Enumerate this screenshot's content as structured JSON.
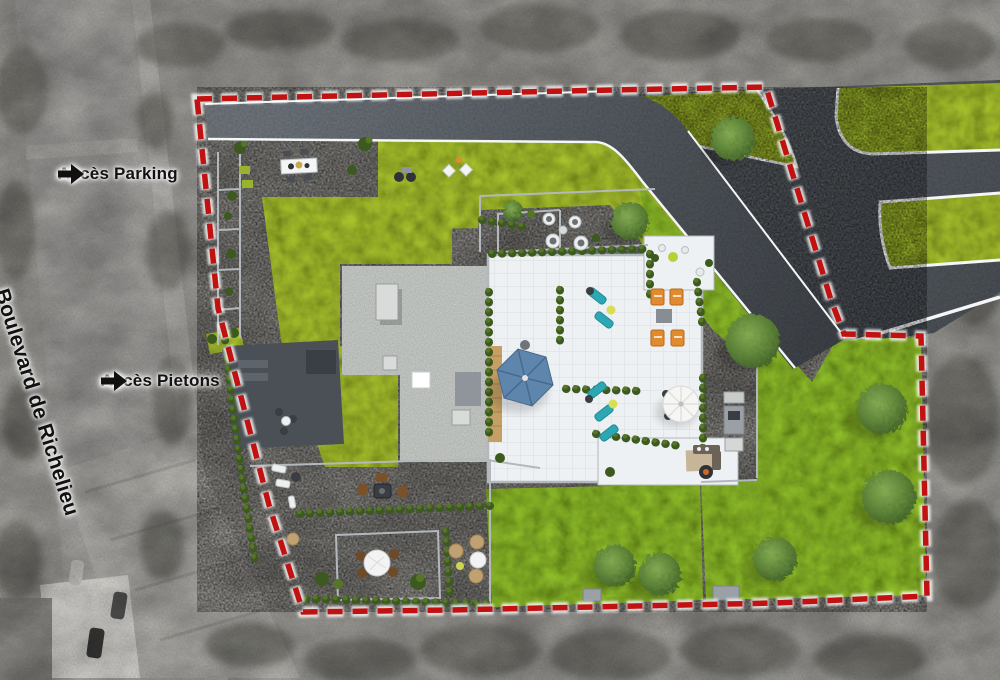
{
  "annotations": {
    "parking_access": {
      "label": "Accès Parking",
      "icon": "arrow-right-icon"
    },
    "pedestrian_access": {
      "label": "Accès Pietons",
      "icon": "arrow-right-icon"
    },
    "street_name": {
      "label": "Boulevard de Richelieu"
    }
  },
  "colors": {
    "boundary-red": "#c11111",
    "boundary-glow": "#ffffff",
    "lawn-yellow": "#a6bf2f",
    "lawn-green": "#8cba2b",
    "hedge-dark": "#3c5920",
    "hedge-light": "#567527",
    "tree-dark": "#3d5c26",
    "tree-mid": "#5d8238",
    "tree-light": "#83aa52",
    "paving": "#dfe3e5",
    "paving-bright": "#eef1f3",
    "concrete": "#ccd0cc",
    "asphalt": "#585e64",
    "asphalt-dark": "#43484e",
    "curb-white": "#f4f6f7",
    "aerial-gray": "#a2a09b",
    "aerial-dark": "#5a5a54",
    "road-gray": "#a8a6a3",
    "wood-tan": "#c5a065",
    "parasol-blue": "#5e86ac",
    "lounger-teal": "#2ea7b4",
    "chair-orange": "#e18a2e",
    "table-yellow": "#d9df52",
    "label-black": "#121212"
  }
}
